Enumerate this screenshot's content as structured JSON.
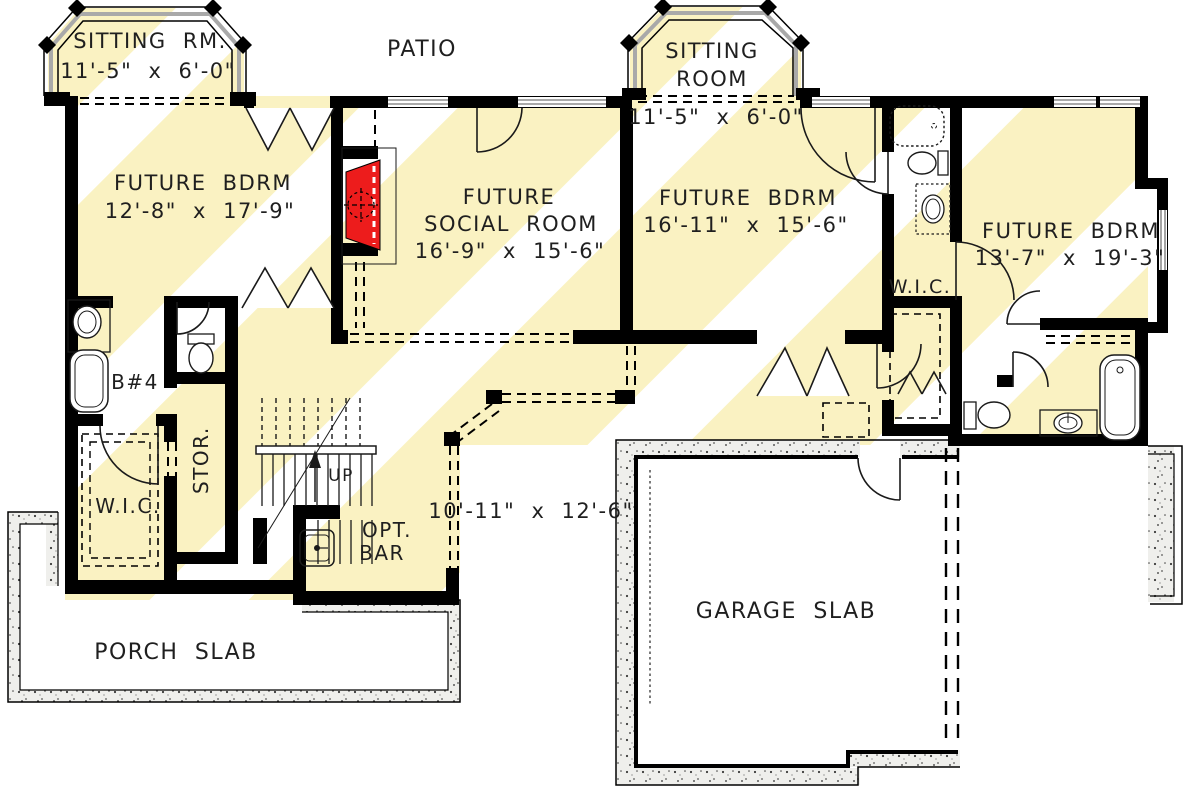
{
  "plan": {
    "labels": {
      "patio": "PATIO",
      "porch_slab": "PORCH SLAB",
      "garage_slab": "GARAGE SLAB",
      "rec_dims": "10'-11\" x 12'-6\"",
      "up": "UP",
      "bath4": "B#4",
      "storage": "STOR.",
      "wic_left": "W.I.C.",
      "wic_right": "W.I.C.",
      "bar_line1": "OPT.",
      "bar_line2": "BAR"
    },
    "rooms": {
      "sitting_left": {
        "name": "SITTING RM.",
        "dims": "11'-5\" x 6'-0\""
      },
      "sitting_right": {
        "name_line1": "SITTING",
        "name_line2": "ROOM",
        "dims": "11'-5\" x 6'-0\""
      },
      "bedroom_left": {
        "name": "FUTURE BDRM",
        "dims": "12'-8\" x 17'-9\""
      },
      "social_room": {
        "name_line1": "FUTURE",
        "name_line2": "SOCIAL ROOM",
        "dims": "16'-9\" x 15'-6\""
      },
      "bedroom_mid": {
        "name": "FUTURE BDRM",
        "dims": "16'-11\" x 15'-6\""
      },
      "bedroom_right": {
        "name": "FUTURE BDRM",
        "dims": "13'-7\" x 19'-3\""
      }
    },
    "colors": {
      "highlight": "#faf2c2",
      "fireplace_red": "#ed1c1c",
      "wall_black": "#000000"
    }
  }
}
